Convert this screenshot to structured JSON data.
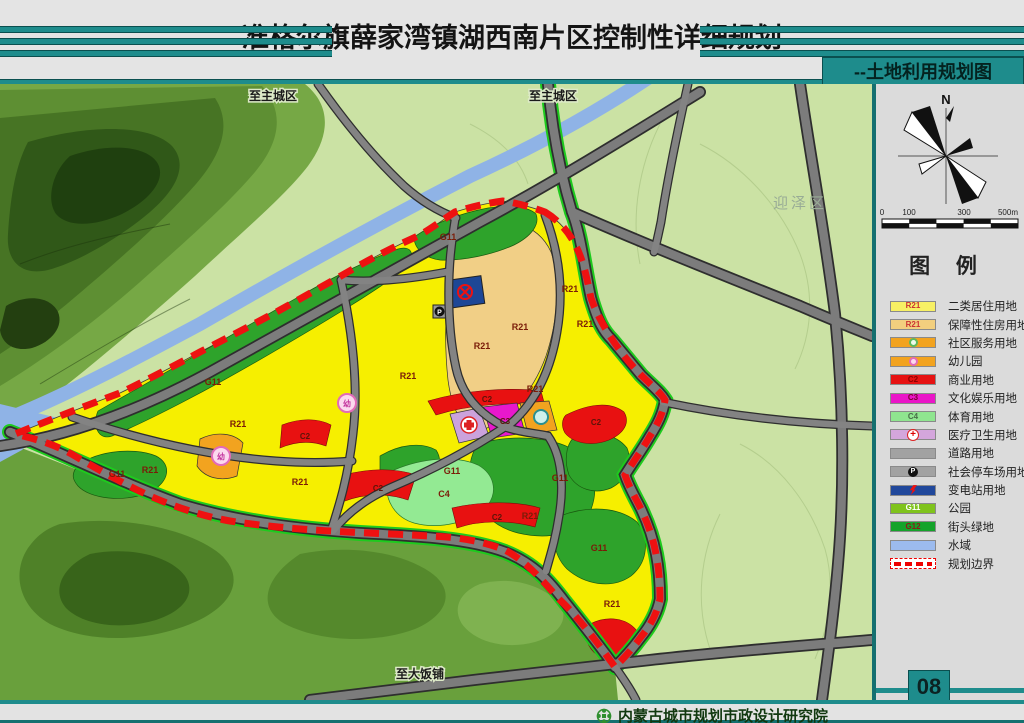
{
  "header": {
    "title": "准格尔旗薛家湾镇湖西南片区控制性详细规划",
    "subtitle": "--土地利用规划图"
  },
  "map": {
    "edge_labels": {
      "top_left": "至主城区",
      "top_right": "至主城区",
      "bottom": "至大饭铺",
      "district": "迎泽区"
    },
    "codes": {
      "r21": "R21",
      "g11": "G11",
      "c2": "C2",
      "c3": "C3",
      "c4": "C4",
      "parking": "P",
      "kindergarten": "幼"
    },
    "boundary_color": "#EE1111",
    "water_color": "#8FB3E6",
    "residential_color": "#F6EF00"
  },
  "compass": {
    "north": "N"
  },
  "scale_bar": {
    "ticks": [
      "0",
      "100",
      "300",
      "500m"
    ]
  },
  "legend": {
    "title": "图 例",
    "items": [
      {
        "code": "R21",
        "code_color": "#CC3333",
        "label": "二类居住用地",
        "color": "#F7F064",
        "icon": ""
      },
      {
        "code": "R21",
        "code_color": "#CC3333",
        "label": "保障性住房用地",
        "color": "#F2CF7E",
        "icon": ""
      },
      {
        "code": "",
        "code_color": "",
        "label": "社区服务用地",
        "color": "#F2A31F",
        "icon": "community-circle"
      },
      {
        "code": "",
        "code_color": "",
        "label": "幼儿园",
        "color": "#F2A31F",
        "icon": "kindergarten-circle"
      },
      {
        "code": "C2",
        "code_color": "#8B0000",
        "label": "商业用地",
        "color": "#E61212",
        "icon": ""
      },
      {
        "code": "C3",
        "code_color": "#7A0030",
        "label": "文化娱乐用地",
        "color": "#EA16C8",
        "icon": ""
      },
      {
        "code": "C4",
        "code_color": "#4A6E4A",
        "label": "体育用地",
        "color": "#8FE58F",
        "icon": ""
      },
      {
        "code": "",
        "code_color": "",
        "label": "医疗卫生用地",
        "color": "#D4A6DC",
        "icon": "medical-cross"
      },
      {
        "code": "",
        "code_color": "",
        "label": "道路用地",
        "color": "#A2A2A2",
        "icon": ""
      },
      {
        "code": "",
        "code_color": "",
        "label": "社会停车场用地",
        "color": "#A2A2A2",
        "icon": "parking-circle"
      },
      {
        "code": "",
        "code_color": "",
        "label": "变电站用地",
        "color": "#21489B",
        "icon": "substation-bolt"
      },
      {
        "code": "G11",
        "code_color": "#FFFFFF",
        "label": "公园",
        "color": "#7FC31C",
        "icon": ""
      },
      {
        "code": "G12",
        "code_color": "#8B1A1A",
        "label": "街头绿地",
        "color": "#14A32A",
        "icon": ""
      },
      {
        "code": "",
        "code_color": "",
        "label": "水域",
        "color": "#9CBBEE",
        "icon": ""
      },
      {
        "code": "",
        "code_color": "",
        "label": "规划边界",
        "color": "#FFFFFF",
        "icon": "dashed-boundary"
      }
    ]
  },
  "footer": {
    "org": "内蒙古城市规划市政设计研究院",
    "page": "08"
  }
}
